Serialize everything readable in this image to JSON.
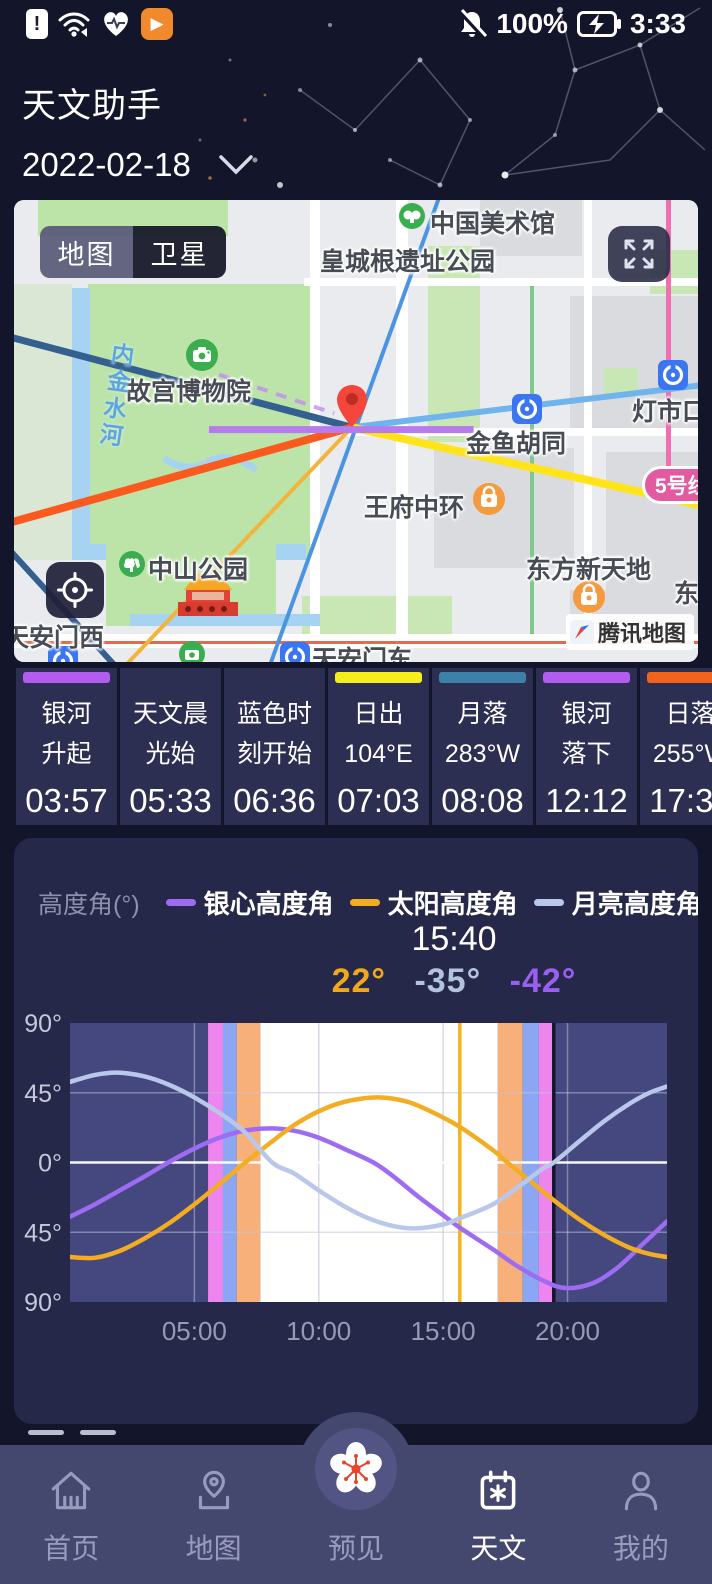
{
  "status_bar": {
    "time": "3:33",
    "battery_percent": "100%"
  },
  "header": {
    "app_title": "天文助手",
    "date": "2022-02-18"
  },
  "map": {
    "toggle": {
      "map_label": "地图",
      "satellite_label": "卫星"
    },
    "badge_line5": "5号线",
    "attribution": "腾讯地图",
    "labels": {
      "art_museum": "中国美术馆",
      "huangchenggen_park": "皇城根遗址公园",
      "palace_museum": "故宫博物院",
      "jinshui_river": "内金水河",
      "dengshikou": "灯市口",
      "jinyu_hutong": "金鱼胡同",
      "wangfu_central": "王府中环",
      "zhongshan_park": "中山公园",
      "oriental_plaza": "东方新天地",
      "dongdan": "东单",
      "tiananmen_west": "天安门西",
      "tiananmen_east": "天安门东"
    },
    "rays": [
      {
        "name": "ray-dark-blue-west",
        "color": "#33608f",
        "width": 7,
        "x1": -0.01,
        "y1": 0.295,
        "x2": 0.494,
        "y2": 0.492
      },
      {
        "name": "ray-blue-northeast",
        "color": "#4d94e0",
        "width": 4,
        "x1": 0.625,
        "y1": -0.02,
        "x2": 0.371,
        "y2": 1.02
      },
      {
        "name": "ray-skyblue-east",
        "color": "#6fb4ed",
        "width": 6,
        "x1": 0.494,
        "y1": 0.492,
        "x2": 1.01,
        "y2": 0.4
      },
      {
        "name": "ray-redorange-west",
        "color": "#fb5a1e",
        "width": 8,
        "x1": -0.01,
        "y1": 0.7,
        "x2": 0.494,
        "y2": 0.492
      },
      {
        "name": "ray-yellow-east",
        "color": "#ffe41a",
        "width": 8,
        "x1": 0.494,
        "y1": 0.492,
        "x2": 1.01,
        "y2": 0.663
      },
      {
        "name": "ray-amber-southwest",
        "color": "#f3b43c",
        "width": 4,
        "x1": 0.494,
        "y1": 0.492,
        "x2": 0.155,
        "y2": 1.02
      },
      {
        "name": "ray-purple-west",
        "color": "#b77bee",
        "width": 7,
        "x1": 0.285,
        "y1": 0.497,
        "x2": 0.672,
        "y2": 0.497
      },
      {
        "name": "ray-purple-dashed",
        "color": "#c18df2",
        "width": 4,
        "dash": "11 9",
        "opacity": 0.8,
        "x1": 0.3,
        "y1": 0.378,
        "x2": 0.468,
        "y2": 0.462
      },
      {
        "name": "ray-darkblue-corner",
        "color": "#33608f",
        "width": 6,
        "x1": -0.005,
        "y1": 0.76,
        "x2": 0.155,
        "y2": 1.02
      }
    ]
  },
  "events": [
    {
      "bar": "#b35cf0",
      "line1": "银河",
      "line2": "升起",
      "time": "03:57"
    },
    {
      "bar": "transparent",
      "line1": "天文晨",
      "line2": "光始",
      "time": "05:33"
    },
    {
      "bar": "transparent",
      "line1": "蓝色时",
      "line2": "刻开始",
      "time": "06:36"
    },
    {
      "bar": "#f4ef1c",
      "line1": "日出",
      "line2": "104°E",
      "time": "07:03"
    },
    {
      "bar": "#3d80a8",
      "line1": "月落",
      "line2": "283°W",
      "time": "08:08"
    },
    {
      "bar": "#b35cf0",
      "line1": "银河",
      "line2": "落下",
      "time": "12:12"
    },
    {
      "bar": "#f2641c",
      "line1": "日落",
      "line2": "255°W",
      "time": "17:35"
    }
  ],
  "chart": {
    "ylabel": "高度角(°)",
    "cursor_time": "15:40",
    "cursor_values": [
      {
        "text": "22°",
        "color": "#f2a81d"
      },
      {
        "text": "-35°",
        "color": "#b4c3de"
      },
      {
        "text": "-42°",
        "color": "#9b5ff0"
      }
    ],
    "chart_data": {
      "type": "line",
      "x_range": [
        0,
        24
      ],
      "y_range": [
        -90,
        90
      ],
      "x_ticks": [
        {
          "t": 5,
          "label": "05:00"
        },
        {
          "t": 10,
          "label": "10:00"
        },
        {
          "t": 15,
          "label": "15:00"
        },
        {
          "t": 20,
          "label": "20:00"
        }
      ],
      "y_ticks": [
        {
          "v": 90,
          "label": "90°"
        },
        {
          "v": 45,
          "label": "45°"
        },
        {
          "v": 0,
          "label": "0°"
        },
        {
          "v": -45,
          "label": "-45°"
        },
        {
          "v": -90,
          "label": "-90°"
        }
      ],
      "bands": [
        {
          "from": 0,
          "to": 5.55,
          "color": "#45477f"
        },
        {
          "from": 5.55,
          "to": 6.15,
          "color": "#ee85ee"
        },
        {
          "from": 6.15,
          "to": 6.7,
          "color": "#8ba7f3"
        },
        {
          "from": 6.7,
          "to": 7.65,
          "color": "#f8b07a"
        },
        {
          "from": 7.65,
          "to": 17.2,
          "color": "#ffffff"
        },
        {
          "from": 17.2,
          "to": 18.2,
          "color": "#f8b07a"
        },
        {
          "from": 18.2,
          "to": 18.85,
          "color": "#8ba7f3"
        },
        {
          "from": 18.85,
          "to": 19.38,
          "color": "#ee85ee"
        },
        {
          "from": 19.38,
          "to": 24,
          "color": "#45477f"
        }
      ],
      "markers": [
        {
          "t": 15.67,
          "color": "#f2b41f",
          "width": 3.5
        },
        {
          "t": 19.45,
          "color": "#15162c",
          "width": 3.5
        }
      ],
      "series": [
        {
          "name": "银心高度角",
          "color": "#9e6cf3",
          "cursor_value": -42,
          "points": [
            [
              0,
              -35
            ],
            [
              1,
              -27
            ],
            [
              2,
              -18
            ],
            [
              3,
              -9
            ],
            [
              3.95,
              0
            ],
            [
              5,
              9
            ],
            [
              6,
              16
            ],
            [
              7,
              20.5
            ],
            [
              8.05,
              22
            ],
            [
              9,
              20.5
            ],
            [
              10,
              16
            ],
            [
              11,
              9
            ],
            [
              12.2,
              0
            ],
            [
              13,
              -9
            ],
            [
              14,
              -22
            ],
            [
              15,
              -34
            ],
            [
              15.67,
              -42
            ],
            [
              17,
              -56
            ],
            [
              18,
              -67
            ],
            [
              19,
              -76
            ],
            [
              19.9,
              -81
            ],
            [
              21,
              -78
            ],
            [
              22,
              -68
            ],
            [
              23,
              -53
            ],
            [
              24,
              -38
            ]
          ]
        },
        {
          "name": "太阳高度角",
          "color": "#f2ad22",
          "cursor_value": 22,
          "points": [
            [
              0,
              -61
            ],
            [
              1,
              -61.5
            ],
            [
              2,
              -57
            ],
            [
              3,
              -49
            ],
            [
              4,
              -39
            ],
            [
              5,
              -27
            ],
            [
              6,
              -14
            ],
            [
              7.05,
              0
            ],
            [
              8,
              12
            ],
            [
              9,
              24
            ],
            [
              10,
              33
            ],
            [
              11,
              39
            ],
            [
              12.33,
              42
            ],
            [
              13.5,
              39.5
            ],
            [
              14.5,
              33
            ],
            [
              15.67,
              23
            ],
            [
              17,
              8
            ],
            [
              17.58,
              0
            ],
            [
              18.5,
              -12
            ],
            [
              19.5,
              -25
            ],
            [
              20.5,
              -37
            ],
            [
              21.5,
              -47
            ],
            [
              22.5,
              -55
            ],
            [
              23.3,
              -59
            ],
            [
              24,
              -61
            ]
          ]
        },
        {
          "name": "月亮高度角",
          "color": "#b9c7ea",
          "cursor_value": -35,
          "points": [
            [
              0,
              52
            ],
            [
              1,
              56.5
            ],
            [
              1.9,
              58
            ],
            [
              3,
              55.5
            ],
            [
              4,
              50
            ],
            [
              5,
              42
            ],
            [
              6,
              32
            ],
            [
              7,
              20
            ],
            [
              8.13,
              0
            ],
            [
              9,
              -7
            ],
            [
              10,
              -18
            ],
            [
              11,
              -28
            ],
            [
              12,
              -36
            ],
            [
              13,
              -41
            ],
            [
              13.9,
              -42.5
            ],
            [
              15,
              -40
            ],
            [
              15.67,
              -36
            ],
            [
              17,
              -27
            ],
            [
              18,
              -16
            ],
            [
              19,
              -4
            ],
            [
              19.45,
              0
            ],
            [
              20.5,
              14
            ],
            [
              21.5,
              27
            ],
            [
              22.5,
              38
            ],
            [
              23.3,
              45
            ],
            [
              24,
              49
            ]
          ]
        }
      ]
    }
  },
  "nav": {
    "items": [
      {
        "label": "首页"
      },
      {
        "label": "地图"
      },
      {
        "label": "预见"
      },
      {
        "label": "天文"
      },
      {
        "label": "我的"
      }
    ]
  }
}
